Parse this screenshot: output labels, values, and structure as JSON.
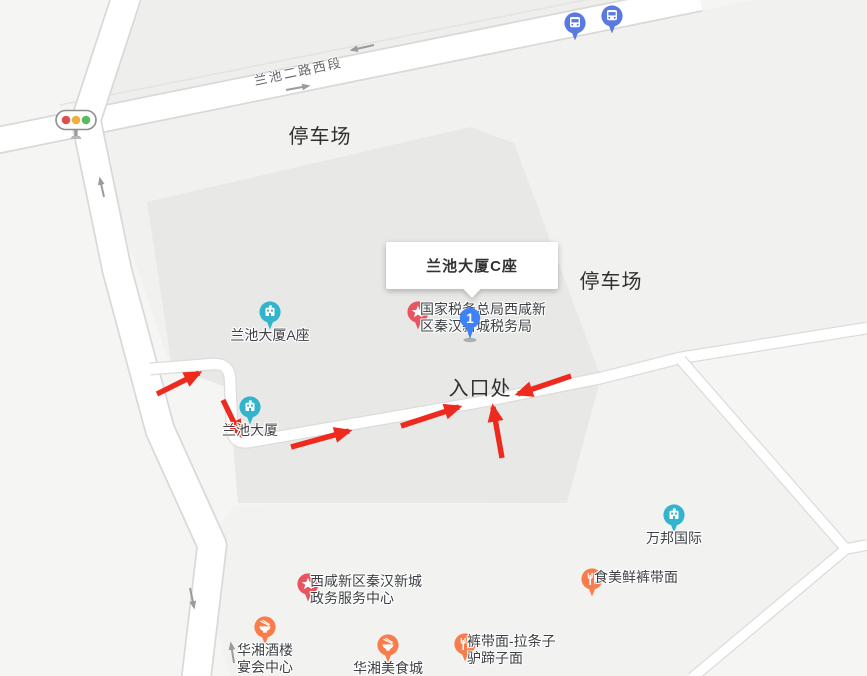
{
  "map": {
    "popup": {
      "title": "兰池大厦C座",
      "x": 386,
      "y": 242,
      "width": 172,
      "height": 47
    },
    "route_marker": {
      "number": "1",
      "x": 470,
      "y": 318,
      "color": "#3e82f7"
    },
    "traffic_light": {
      "x": 76,
      "y": 119,
      "red": "#dd4f4f",
      "amber": "#efaf3d",
      "green": "#57bb63"
    },
    "road_label": {
      "text": "兰池二路西段",
      "x": 298,
      "y": 70,
      "rotation_deg": -12
    },
    "annotations": [
      {
        "text": "停车场",
        "x": 320,
        "y": 133
      },
      {
        "text": "停车场",
        "x": 611,
        "y": 278
      },
      {
        "text": "入口处",
        "x": 480,
        "y": 385
      }
    ],
    "pois": [
      {
        "id": "lanchi-tower-a",
        "icon": "building",
        "color": "#31b4cc",
        "x": 270,
        "y": 312,
        "label_lines": [
          "兰池大厦A座"
        ],
        "label_pos": "below"
      },
      {
        "id": "lanchi-tower",
        "icon": "building",
        "color": "#31b4cc",
        "x": 250,
        "y": 407,
        "label_lines": [
          "兰池大厦"
        ],
        "label_pos": "below"
      },
      {
        "id": "wanbang-intl",
        "icon": "building",
        "color": "#31b4cc",
        "x": 674,
        "y": 515,
        "label_lines": [
          "万邦国际"
        ],
        "label_pos": "below"
      },
      {
        "id": "tax-bureau",
        "icon": "star",
        "color": "#e85560",
        "x": 418,
        "y": 312,
        "label_lines": [
          "国家税务总局西咸新",
          "区秦汉新城税务局"
        ],
        "label_pos": "right"
      },
      {
        "id": "gov-service-center",
        "icon": "star",
        "color": "#e85560",
        "x": 308,
        "y": 584,
        "label_lines": [
          "西咸新区秦汉新城",
          "政务服务中心"
        ],
        "label_pos": "right"
      },
      {
        "id": "shimeixian-noodles",
        "icon": "restaurant",
        "color": "#fa7c4b",
        "x": 592,
        "y": 579,
        "label_lines": [
          "食美鲜裤带面"
        ],
        "label_pos": "right"
      },
      {
        "id": "kudaimian-noodles",
        "icon": "restaurant",
        "color": "#fa7c4b",
        "x": 465,
        "y": 644,
        "label_lines": [
          "裤带面-拉条子",
          "驴蹄子面"
        ],
        "label_pos": "right"
      },
      {
        "id": "huaxiang-banquet",
        "icon": "bowl",
        "color": "#fa7c4b",
        "x": 265,
        "y": 627,
        "label_lines": [
          "华湘酒楼",
          "宴会中心"
        ],
        "label_pos": "below"
      },
      {
        "id": "huaxiang-food-city",
        "icon": "bowl",
        "color": "#fa7c4b",
        "x": 388,
        "y": 645,
        "label_lines": [
          "华湘美食城"
        ],
        "label_pos": "below"
      }
    ],
    "transit_stops": [
      {
        "id": "bus-stop-1",
        "x": 575,
        "y": 23
      },
      {
        "id": "bus-stop-2",
        "x": 612,
        "y": 16
      }
    ],
    "transit_color": "#5b79e3",
    "route_arrow_color": "#ee2a1e",
    "route_arrows": [
      {
        "x1": 157,
        "y1": 394,
        "x2": 199,
        "y2": 373
      },
      {
        "x1": 223,
        "y1": 400,
        "x2": 240,
        "y2": 435
      },
      {
        "x1": 291,
        "y1": 447,
        "x2": 349,
        "y2": 431
      },
      {
        "x1": 401,
        "y1": 426,
        "x2": 459,
        "y2": 407
      },
      {
        "x1": 502,
        "y1": 458,
        "x2": 493,
        "y2": 407
      },
      {
        "x1": 571,
        "y1": 376,
        "x2": 518,
        "y2": 394
      }
    ],
    "lane_arrow_color": "#9b9b9b",
    "lane_arrows": [
      {
        "x1": 374,
        "y1": 45,
        "x2": 352,
        "y2": 50
      },
      {
        "x1": 286,
        "y1": 90,
        "x2": 308,
        "y2": 86
      },
      {
        "x1": 104,
        "y1": 197,
        "x2": 100,
        "y2": 179
      },
      {
        "x1": 190,
        "y1": 588,
        "x2": 194,
        "y2": 607
      },
      {
        "x1": 234,
        "y1": 663,
        "x2": 231,
        "y2": 644
      }
    ]
  }
}
